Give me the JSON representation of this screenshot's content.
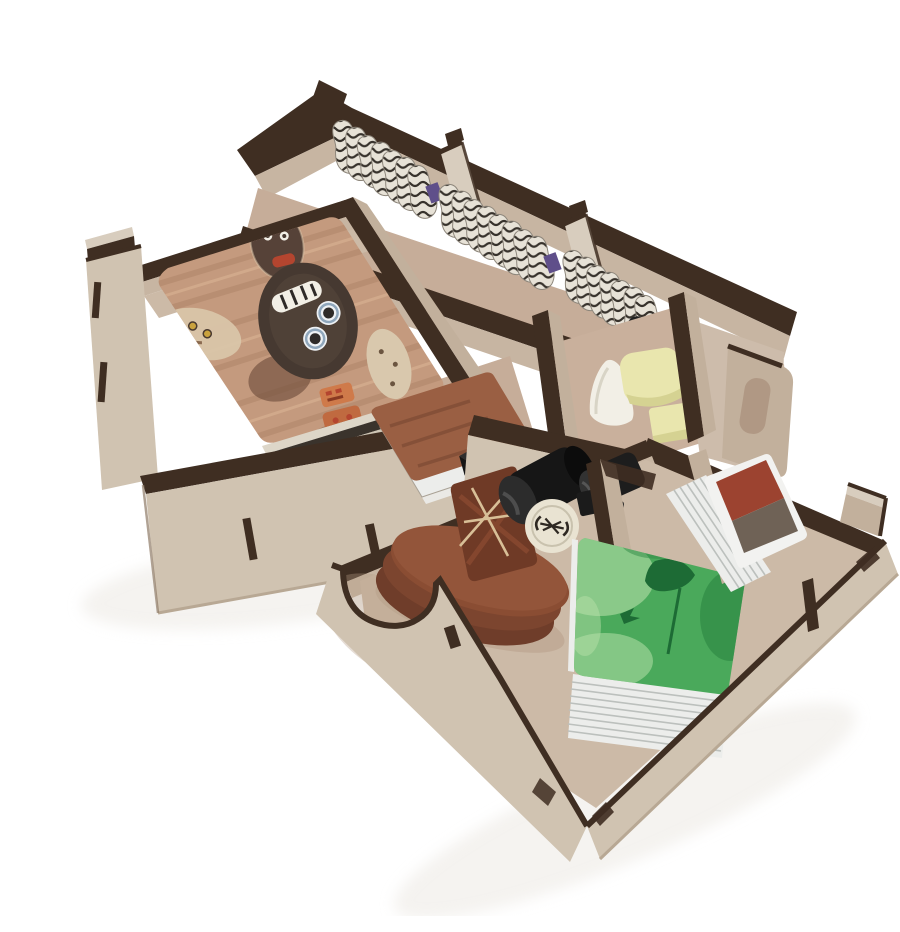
{
  "photo": {
    "width": 900,
    "height": 900,
    "background": "#ffffff",
    "subject": "Studio product photo of two laser-cut wooden board game organizer trays filled with game components, on a plain white background"
  },
  "palette": {
    "bg": "#ffffff",
    "burnt": "#3f2e22",
    "burnt2": "#5d4837",
    "woodtop": "#d8cdbe",
    "woodface": "#d0c3b1",
    "woodface2": "#c2b09c",
    "woodinner": "#c7b5a2",
    "floor": "#ccbaa7",
    "floorpink": "#c6ad99",
    "black": "#161616",
    "blackhi": "#3e3e3e",
    "whitepc": "#f2efe6",
    "cream": "#e9e6ae",
    "cream2": "#d5d292",
    "cardwood": "#c49a7e",
    "cardwood2": "#a87e62",
    "maskdark": "#463931",
    "maskpale": "#d9c5a9",
    "orange": "#cf7a4a",
    "red": "#b4452f",
    "tokbase": "#e7e2d7",
    "tokstripe": "#37322c",
    "discside": "#71412c",
    "disctop": "#6f3a26",
    "discline": "#d8bf97",
    "green": "#4aa95b",
    "greendk": "#1d6b35",
    "greenlt": "#b5e0a8",
    "cardedge": "#ecedeb",
    "cardline": "#bcc0bd",
    "smallred": "#9c4330",
    "smallgray": "#6f6256",
    "shadow": "#eae6e0"
  },
  "back_tray": {
    "label": "rear wooden organizer tray with card bay, token channel and piece bays",
    "token_stacks": 4,
    "token_dividers": 3,
    "bays": 5
  },
  "mask_card": {
    "label": "oversized game card showing carved tribal masks on weathered wood"
  },
  "card_stack_under": {
    "label": "stack of cards beneath the top mask card"
  },
  "fanned_cards": {
    "label": "fanned pile of wood-backed square cards"
  },
  "die": {
    "label": "black die with white pips",
    "pips_visible": 5
  },
  "striped_tokens": {
    "label": "rows of wavy black-and-white striped cardboard tokens"
  },
  "black_tokens": {
    "label": "dark tokens with a white symbol",
    "count": 7
  },
  "white_meeple": {
    "label": "white wooden pawn"
  },
  "cream_pieces": {
    "label": "pale yellow wooden blocks",
    "count": 2
  },
  "front_tray": {
    "label": "front wooden organizer tray with disc well, card wells and finger notches"
  },
  "disc_stack": {
    "label": "stack of large round wooden discs topped by a dark tile with pale compass lines"
  },
  "cylinders": {
    "label": "black wooden cylinders",
    "count": 2
  },
  "white_token": {
    "label": "round ivory token with a dark hourglass mark"
  },
  "green_deck": {
    "label": "tall deck of cards, green misty top card with a dark figure silhouette"
  },
  "small_deck": {
    "label": "small deck of cards standing on edge, dark red back"
  }
}
